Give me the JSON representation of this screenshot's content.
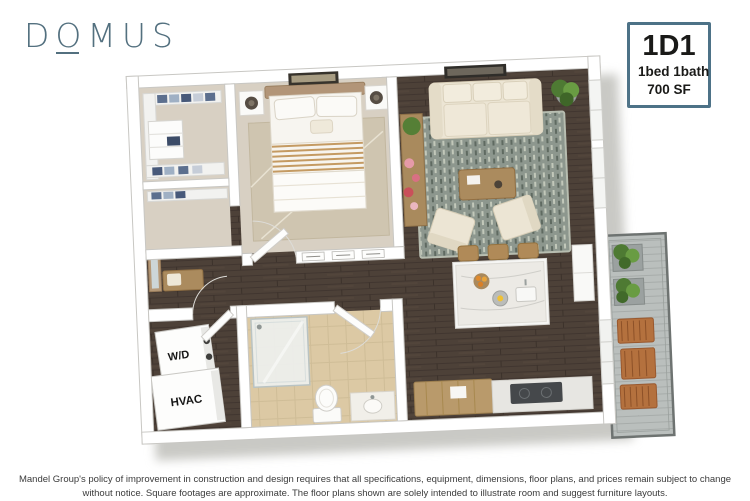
{
  "brand": {
    "logo_text": "DOMUS",
    "logo_color": "#53707f"
  },
  "unit_badge": {
    "unit": "1D1",
    "config": "1bed 1bath",
    "area": "700 SF",
    "border_color": "#4d7287",
    "text_color": "#1a1a18"
  },
  "floor_plan": {
    "labels": {
      "washer_dryer": "W/D",
      "hvac": "HVAC"
    },
    "rooms": [
      "walk-in closet",
      "bedroom",
      "living room",
      "entry hall",
      "utility closet",
      "bathroom",
      "kitchen",
      "balcony"
    ],
    "colors": {
      "wall": "#ffffff",
      "wood_floor": "#4d4138",
      "carpet": "#d8d0c3",
      "bath_tile": "#dcc9a4",
      "area_rug": "#8d978e",
      "bedroom_rug": "#cfc5b0",
      "sofa": "#ece5d4",
      "wood_furniture": "#ab8b5e",
      "plant": "#4e7a33",
      "balcony_deck": "#babfbd",
      "outdoor_wood": "#b4713e",
      "headboard": "#b29578"
    }
  },
  "disclaimer": {
    "text": "Mandel Group's policy of improvement in construction and design requires that all specifications, equipment, dimensions, floor plans, and prices remain subject to change without notice. Square footages are approximate. The floor plans shown are solely intended to illustrate room and suggest furniture layouts."
  }
}
